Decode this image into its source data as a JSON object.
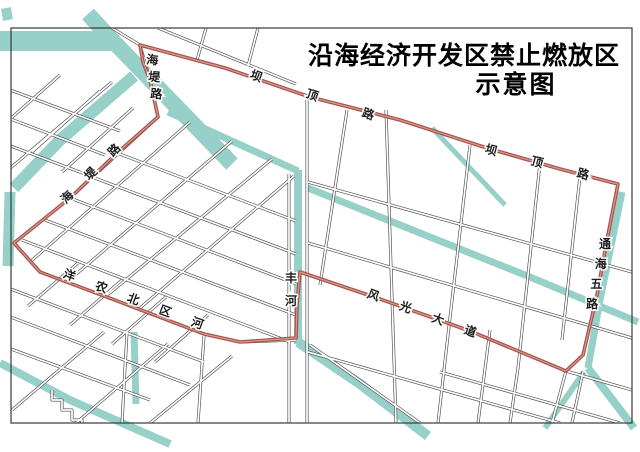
{
  "title": {
    "line1": "沿海经济开发区禁止燃放区",
    "line2": "示意图"
  },
  "colors": {
    "background": "#ffffff",
    "water": "#97cfc9",
    "water_light": "#aedad4",
    "road_casing": "#4a4a4a",
    "road_fill": "#ffffff",
    "boundary_red": "#a85149",
    "boundary_core": "#d49a91",
    "frame": "#3a3a3a",
    "label_text": "#1c1c1c"
  },
  "map": {
    "frame": {
      "x": 11,
      "y": 28,
      "width": 621,
      "height": 395
    },
    "boundary": {
      "name": "no-fireworks-zone-boundary",
      "points": [
        [
          140,
          45
        ],
        [
          225,
          68
        ],
        [
          310,
          97
        ],
        [
          400,
          120
        ],
        [
          490,
          149
        ],
        [
          560,
          169
        ],
        [
          618,
          184
        ],
        [
          607,
          240
        ],
        [
          597,
          295
        ],
        [
          583,
          355
        ],
        [
          566,
          371
        ],
        [
          470,
          331
        ],
        [
          380,
          299
        ],
        [
          300,
          272
        ],
        [
          297,
          305
        ],
        [
          296,
          338
        ],
        [
          240,
          342
        ],
        [
          204,
          334
        ],
        [
          120,
          302
        ],
        [
          40,
          272
        ],
        [
          14,
          243
        ],
        [
          70,
          198
        ],
        [
          117,
          153
        ],
        [
          158,
          117
        ],
        [
          150,
          80
        ],
        [
          143,
          62
        ]
      ]
    },
    "waterways": [
      {
        "name": "canal-top-horizontal",
        "w": 20,
        "pts": [
          [
            0,
            41
          ],
          [
            112,
            41
          ]
        ]
      },
      {
        "name": "canal-top-diagonal",
        "w": 16,
        "pts": [
          [
            88,
            14
          ],
          [
            112,
            40
          ],
          [
            232,
            164
          ]
        ]
      },
      {
        "name": "canal-thin-northeast",
        "w": 7,
        "pts": [
          [
            168,
            112
          ],
          [
            298,
            171
          ]
        ]
      },
      {
        "name": "fenghe-river-vertical",
        "w": 8,
        "pts": [
          [
            298,
            170
          ],
          [
            298,
            344
          ]
        ]
      },
      {
        "name": "fenghe-river-southeast",
        "w": 10,
        "pts": [
          [
            298,
            342
          ],
          [
            360,
            384
          ],
          [
            428,
            436
          ]
        ]
      },
      {
        "name": "east-canal-diagonal",
        "w": 7,
        "pts": [
          [
            308,
            188
          ],
          [
            420,
            233
          ],
          [
            530,
            277
          ],
          [
            638,
            322
          ]
        ]
      },
      {
        "name": "tonghai-roadside-canal",
        "w": 7,
        "pts": [
          [
            622,
            192
          ],
          [
            600,
            300
          ],
          [
            588,
            368
          ]
        ]
      },
      {
        "name": "tonghai-canal-southeast",
        "w": 8,
        "pts": [
          [
            588,
            368
          ],
          [
            634,
            428
          ]
        ]
      },
      {
        "name": "tonghai-canal-southwest",
        "w": 6,
        "pts": [
          [
            584,
            372
          ],
          [
            545,
            428
          ]
        ]
      },
      {
        "name": "west-branch-canal",
        "w": 12,
        "pts": [
          [
            134,
            76
          ],
          [
            60,
            140
          ],
          [
            14,
            188
          ]
        ]
      },
      {
        "name": "west-edge-canal",
        "w": 11,
        "pts": [
          [
            10,
            192
          ],
          [
            8,
            266
          ]
        ]
      },
      {
        "name": "southwest-canal",
        "w": 8,
        "pts": [
          [
            0,
            363
          ],
          [
            70,
            400
          ],
          [
            138,
            430
          ],
          [
            170,
            444
          ]
        ]
      },
      {
        "name": "southwest-canal-vertical",
        "w": 7,
        "pts": [
          [
            134,
            332
          ],
          [
            136,
            404
          ]
        ]
      },
      {
        "name": "short-east-canal",
        "w": 5,
        "pts": [
          [
            432,
            128
          ],
          [
            470,
            168
          ],
          [
            505,
            205
          ]
        ]
      },
      {
        "name": "top-left-pond",
        "w": 10,
        "pts": [
          [
            6,
            8
          ],
          [
            8,
            20
          ]
        ]
      }
    ],
    "roads": [
      {
        "name": "badinglu-road",
        "pts": [
          [
            112,
            28
          ],
          [
            140,
            45
          ],
          [
            225,
            68
          ],
          [
            310,
            97
          ],
          [
            400,
            120
          ],
          [
            490,
            149
          ],
          [
            560,
            169
          ],
          [
            618,
            184
          ]
        ]
      },
      {
        "name": "tonghai-wulu-road",
        "pts": [
          [
            618,
            184
          ],
          [
            607,
            240
          ],
          [
            597,
            295
          ],
          [
            583,
            355
          ],
          [
            566,
            371
          ],
          [
            552,
            423
          ]
        ]
      },
      {
        "name": "fengguang-avenue",
        "pts": [
          [
            300,
            272
          ],
          [
            380,
            299
          ],
          [
            470,
            331
          ],
          [
            566,
            371
          ],
          [
            632,
            390
          ]
        ]
      },
      {
        "name": "yangnong-river-road",
        "pts": [
          [
            14,
            243
          ],
          [
            40,
            272
          ],
          [
            120,
            302
          ],
          [
            204,
            334
          ],
          [
            240,
            342
          ],
          [
            296,
            340
          ]
        ]
      },
      {
        "name": "haidi-road",
        "pts": [
          [
            140,
            45
          ],
          [
            150,
            80
          ],
          [
            158,
            117
          ],
          [
            70,
            198
          ],
          [
            14,
            243
          ]
        ]
      },
      {
        "name": "river-road-west",
        "pts": [
          [
            289,
            174
          ],
          [
            289,
            423
          ]
        ]
      },
      {
        "name": "river-road-east",
        "pts": [
          [
            307,
            100
          ],
          [
            307,
            423
          ]
        ]
      },
      {
        "name": "main-vertical-road",
        "pts": [
          [
            386,
            110
          ],
          [
            396,
            423
          ]
        ]
      },
      {
        "name": "grid-road",
        "pts": [
          [
            308,
            182
          ],
          [
            632,
            272
          ]
        ]
      },
      {
        "name": "grid-road",
        "pts": [
          [
            308,
            243
          ],
          [
            632,
            338
          ]
        ]
      },
      {
        "name": "grid-road",
        "pts": [
          [
            308,
            352
          ],
          [
            560,
            423
          ]
        ]
      },
      {
        "name": "grid-road",
        "pts": [
          [
            440,
            372
          ],
          [
            620,
            423
          ]
        ]
      },
      {
        "name": "grid-road",
        "pts": [
          [
            347,
            110
          ],
          [
            320,
            285
          ]
        ]
      },
      {
        "name": "grid-road",
        "pts": [
          [
            470,
            145
          ],
          [
            448,
            335
          ],
          [
            438,
            423
          ]
        ]
      },
      {
        "name": "grid-road",
        "pts": [
          [
            540,
            163
          ],
          [
            518,
            368
          ],
          [
            510,
            423
          ]
        ]
      },
      {
        "name": "grid-road",
        "pts": [
          [
            580,
            176
          ],
          [
            562,
            340
          ]
        ]
      },
      {
        "name": "grid-road",
        "pts": [
          [
            490,
            330
          ],
          [
            478,
            423
          ]
        ]
      },
      {
        "name": "grid-road",
        "pts": [
          [
            583,
            372
          ],
          [
            572,
            423
          ]
        ]
      },
      {
        "name": "grid-road",
        "pts": [
          [
            190,
            122
          ],
          [
            30,
            262
          ]
        ]
      },
      {
        "name": "grid-road",
        "pts": [
          [
            232,
            141
          ],
          [
            67,
            282
          ]
        ]
      },
      {
        "name": "grid-road",
        "pts": [
          [
            272,
            159
          ],
          [
            105,
            297
          ]
        ]
      },
      {
        "name": "grid-road",
        "pts": [
          [
            294,
            176
          ],
          [
            140,
            308
          ]
        ]
      },
      {
        "name": "grid-road",
        "pts": [
          [
            117,
            153
          ],
          [
            296,
            221
          ]
        ]
      },
      {
        "name": "grid-road",
        "pts": [
          [
            92,
            177
          ],
          [
            296,
            254
          ]
        ]
      },
      {
        "name": "grid-road",
        "pts": [
          [
            70,
            198
          ],
          [
            296,
            284
          ]
        ]
      },
      {
        "name": "grid-road",
        "pts": [
          [
            45,
            220
          ],
          [
            296,
            315
          ]
        ]
      },
      {
        "name": "grid-road",
        "pts": [
          [
            22,
            240
          ],
          [
            290,
            342
          ]
        ]
      },
      {
        "name": "grid-road",
        "pts": [
          [
            112,
            82
          ],
          [
            8,
            170
          ]
        ]
      },
      {
        "name": "grid-road",
        "pts": [
          [
            5,
            88
          ],
          [
            120,
            131
          ]
        ]
      },
      {
        "name": "grid-road",
        "pts": [
          [
            0,
            115
          ],
          [
            105,
            155
          ]
        ]
      },
      {
        "name": "grid-road",
        "pts": [
          [
            0,
            142
          ],
          [
            85,
            174
          ]
        ]
      },
      {
        "name": "grid-road",
        "pts": [
          [
            60,
            75
          ],
          [
            0,
            128
          ]
        ]
      },
      {
        "name": "grid-road",
        "pts": [
          [
            100,
            91
          ],
          [
            32,
            152
          ]
        ]
      },
      {
        "name": "grid-road",
        "pts": [
          [
            133,
            108
          ],
          [
            62,
            172
          ]
        ]
      },
      {
        "name": "grid-road",
        "pts": [
          [
            158,
            28
          ],
          [
            296,
            84
          ]
        ]
      },
      {
        "name": "grid-road",
        "pts": [
          [
            206,
            28
          ],
          [
            197,
            60
          ]
        ]
      },
      {
        "name": "grid-road",
        "pts": [
          [
            258,
            28
          ],
          [
            248,
            66
          ]
        ]
      },
      {
        "name": "grid-road",
        "pts": [
          [
            0,
            285
          ],
          [
            204,
            362
          ]
        ]
      },
      {
        "name": "grid-road",
        "pts": [
          [
            0,
            313
          ],
          [
            190,
            385
          ]
        ]
      },
      {
        "name": "grid-road",
        "pts": [
          [
            0,
            345
          ],
          [
            150,
            400
          ]
        ]
      },
      {
        "name": "grid-road",
        "pts": [
          [
            78,
            263
          ],
          [
            28,
            306
          ]
        ]
      },
      {
        "name": "grid-road",
        "pts": [
          [
            122,
            280
          ],
          [
            70,
            325
          ]
        ]
      },
      {
        "name": "grid-road",
        "pts": [
          [
            166,
            297
          ],
          [
            112,
            344
          ]
        ]
      },
      {
        "name": "grid-road",
        "pts": [
          [
            208,
            315
          ],
          [
            155,
            362
          ]
        ]
      },
      {
        "name": "grid-road",
        "pts": [
          [
            104,
            332
          ],
          [
            12,
            410
          ]
        ]
      },
      {
        "name": "grid-road",
        "pts": [
          [
            168,
            344
          ],
          [
            76,
            423
          ]
        ]
      },
      {
        "name": "grid-road",
        "pts": [
          [
            232,
            356
          ],
          [
            150,
            423
          ]
        ]
      },
      {
        "name": "grid-road",
        "pts": [
          [
            204,
            336
          ],
          [
            198,
            423
          ]
        ]
      },
      {
        "name": "grid-road",
        "pts": [
          [
            127,
            332
          ],
          [
            122,
            423
          ]
        ]
      },
      {
        "name": "grid-road",
        "pts": [
          [
            310,
            345
          ],
          [
            420,
            423
          ]
        ]
      },
      {
        "name": "stepped-parcel",
        "pts": [
          [
            52,
            390
          ],
          [
            52,
            400
          ],
          [
            62,
            400
          ],
          [
            62,
            410
          ],
          [
            72,
            410
          ],
          [
            72,
            420
          ],
          [
            82,
            420
          ],
          [
            82,
            430
          ],
          [
            92,
            430
          ],
          [
            92,
            438
          ]
        ]
      }
    ],
    "labels": [
      {
        "name": "road-label-badinglu-west",
        "text": "坝顶路",
        "x": 255,
        "y": 80,
        "dx": 56,
        "dy": 19,
        "rot": 19
      },
      {
        "name": "road-label-badinglu-east",
        "text": "坝顶路",
        "x": 490,
        "y": 154,
        "dx": 46,
        "dy": 12,
        "rot": 15
      },
      {
        "name": "road-label-tonghai-wulu",
        "text": "通海五路",
        "x": 605,
        "y": 248,
        "dx": -4.3,
        "dy": 20,
        "rot": 0
      },
      {
        "name": "road-label-fengguang-avenue",
        "text": "风光大道",
        "x": 372,
        "y": 299,
        "dx": 32.3,
        "dy": 12,
        "rot": 20
      },
      {
        "name": "river-label-yangnong-beiqu",
        "text": "洋农北区河",
        "x": 68,
        "y": 279,
        "dx": 32,
        "dy": 12,
        "rot": 20
      },
      {
        "name": "river-label-fenghe",
        "text": "丰河",
        "x": 291,
        "y": 282,
        "dx": 0,
        "dy": 23,
        "rot": 0
      },
      {
        "name": "road-label-haidi-south",
        "text": "海堤路",
        "x": 70,
        "y": 200,
        "dx": 23.5,
        "dy": -23.5,
        "rot": -45
      },
      {
        "name": "road-label-haidi-north",
        "text": "海堤路",
        "x": 152,
        "y": 64,
        "dx": 2,
        "dy": 17,
        "rot": 5
      }
    ]
  }
}
